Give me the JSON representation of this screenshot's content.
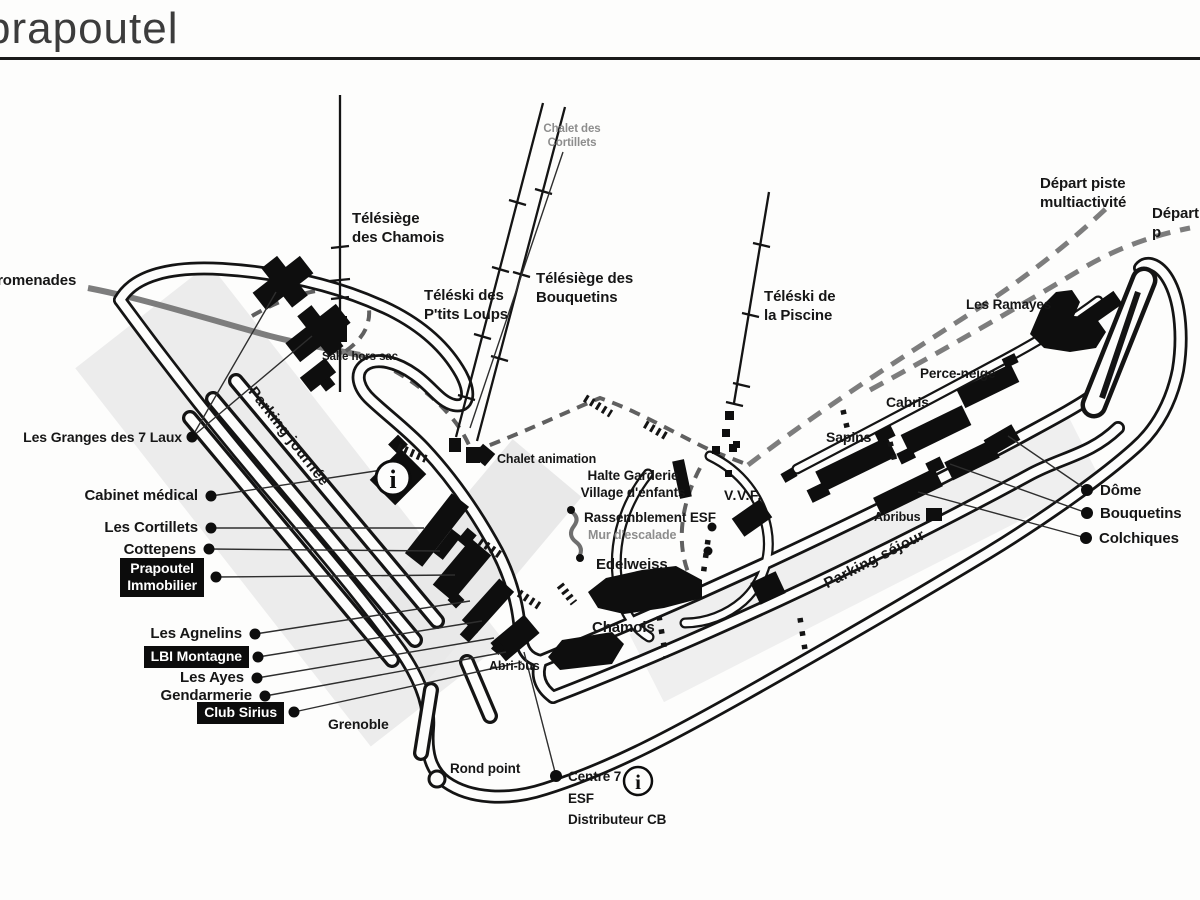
{
  "page": {
    "title": "prapoutel"
  },
  "map": {
    "labels": {
      "chalet_cortillets": {
        "text": "Chalet des\nCortillets"
      },
      "telesiege_chamois": {
        "text": "Télésiège\ndes Chamois"
      },
      "teleski_ptits_loups": {
        "text": "Téléski des\nP'tits Loups"
      },
      "telesiege_bouquetins": {
        "text": "Télésiège des\nBouquetins"
      },
      "teleski_piscine": {
        "text": "Téléski de\nla Piscine"
      },
      "depart_multiactivite": {
        "text": "Départ piste multiactivité"
      },
      "depart_p": {
        "text": "Départ p"
      },
      "les_ramayes": {
        "text": "Les Ramayes"
      },
      "promenades": {
        "text": "promenades"
      },
      "parking_journee": {
        "text": "Parking journée"
      },
      "parking_sejour": {
        "text": "Parking séjour"
      },
      "les_granges": {
        "text": "Les Granges des 7 Laux"
      },
      "cabinet_medical": {
        "text": "Cabinet médical"
      },
      "les_cortillets": {
        "text": "Les Cortillets"
      },
      "cottepens": {
        "text": "Cottepens"
      },
      "prapoutel_immobilier": {
        "text": "Prapoutel\nImmobilier"
      },
      "les_agnelins": {
        "text": "Les Agnelins"
      },
      "lbi_montagne": {
        "text": "LBI Montagne"
      },
      "les_ayes": {
        "text": "Les Ayes"
      },
      "gendarmerie": {
        "text": "Gendarmerie"
      },
      "club_sirius": {
        "text": "Club Sirius"
      },
      "grenoble": {
        "text": "Grenoble"
      },
      "rond_point": {
        "text": "Rond point"
      },
      "centre7": {
        "text": "Centre 7\nESF\nDistributeur CB"
      },
      "chalet_animation": {
        "text": "Chalet animation"
      },
      "halte_garderie": {
        "text": "Halte Garderie\nVillage d'enfants"
      },
      "rassemblement_esf": {
        "text": "Rassemblement ESF"
      },
      "mur_escalade": {
        "text": "Mur d'escalade"
      },
      "vvf": {
        "text": "V.V.F."
      },
      "edelweiss": {
        "text": "Edelweiss"
      },
      "chamois": {
        "text": "Chamois"
      },
      "abri_bus": {
        "text": "Abri-bus"
      },
      "abribus": {
        "text": "Abribus"
      },
      "salle_hors_sac": {
        "text": "Salle hors sac"
      },
      "perce_neige": {
        "text": "Perce-neige"
      },
      "cabris": {
        "text": "Cabris"
      },
      "sapins": {
        "text": "Sapins"
      },
      "dome": {
        "text": "Dôme"
      },
      "bouquetins": {
        "text": "Bouquetins"
      },
      "colchiques": {
        "text": "Colchiques"
      }
    },
    "icons": {
      "info": "i"
    },
    "colors": {
      "ink": "#141414",
      "gray_label": "#8d8d8d",
      "promenade": "#7d7d7d",
      "paper": "#fdfdfc"
    }
  }
}
